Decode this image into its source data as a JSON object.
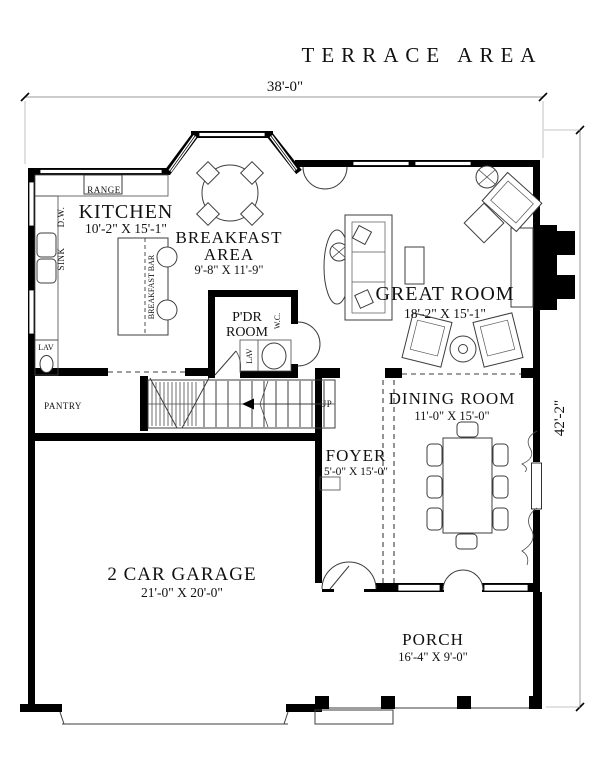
{
  "title": "TERRACE AREA",
  "dimensions": {
    "width_overall": "38'-0\"",
    "height_overall": "42'-2\""
  },
  "rooms": {
    "kitchen": {
      "name": "KITCHEN",
      "dims": "10'-2\" X 15'-1\""
    },
    "breakfast": {
      "name1": "BREAKFAST",
      "name2": "AREA",
      "dims": "9'-8\" X 11'-9\""
    },
    "great_room": {
      "name": "GREAT ROOM",
      "dims": "18'-2\" X 15'-1\""
    },
    "pdr_room": {
      "name1": "P'DR",
      "name2": "ROOM"
    },
    "dining": {
      "name": "DINING ROOM",
      "dims": "11'-0\" X 15'-0\""
    },
    "foyer": {
      "name": "FOYER",
      "dims": "5'-0\" X 15'-0\""
    },
    "garage": {
      "name": "2 CAR GARAGE",
      "dims": "21'-0\" X 20'-0\""
    },
    "porch": {
      "name": "PORCH",
      "dims": "16'-4\" X 9'-0\""
    }
  },
  "labels": {
    "range": "RANGE",
    "dw": "D.W.",
    "sink": "SINK",
    "lav_left": "LAV",
    "breakfast_bar": "BREAKFAST BAR",
    "pantry": "PANTRY",
    "wc": "W.C.",
    "lav_pdr": "LAV",
    "up": "UP"
  },
  "colors": {
    "wall": "#000000",
    "furniture_line": "#3d3d3d",
    "dimension_line": "#9a9a9a",
    "text": "#111111",
    "background": "#ffffff"
  }
}
